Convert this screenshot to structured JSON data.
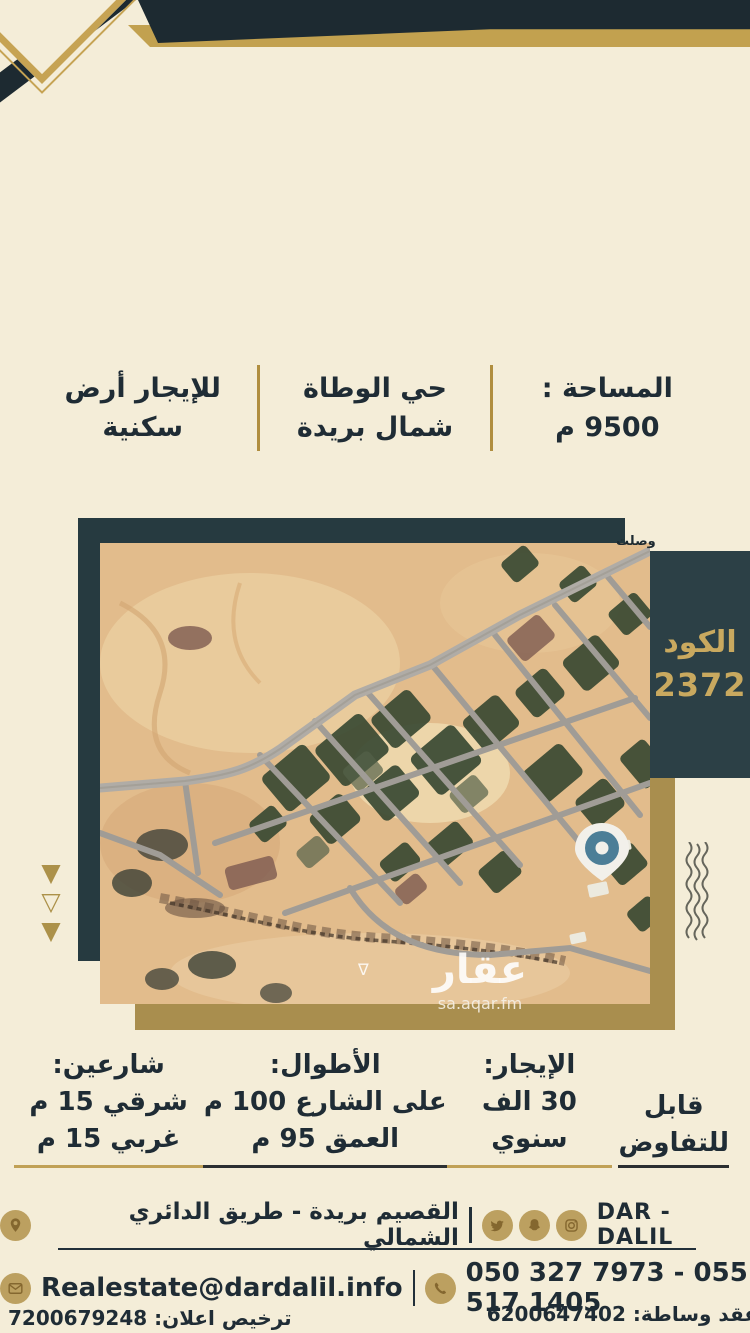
{
  "top_info": {
    "listing": {
      "line1": "للإيجار أرض",
      "line2": "سكنية"
    },
    "location": {
      "line1": "حي الوطاة",
      "line2": "شمال بريدة"
    },
    "area": {
      "line1": "المساحة :",
      "line2": "9500 م"
    }
  },
  "map": {
    "code_label": "الكود",
    "code_value": "2372",
    "corner_text": "وصلت",
    "watermark_wasalt": "wasalt.com",
    "watermark_aqar": "عقار",
    "watermark_aqar_domain": "sa.aqar.fm",
    "triangle_glyphs": {
      "filled": "▼",
      "hollow": "▽"
    }
  },
  "specs": {
    "streets": {
      "title": "شارعين:",
      "line1": "شرقي 15 م",
      "line2": "غربي 15 م"
    },
    "lengths": {
      "title": "الأطوال:",
      "line1": "على الشارع 100 م",
      "line2": "العمق 95 م"
    },
    "rent": {
      "title": "الإيجار:",
      "line1": "30 الف سنوي"
    },
    "negotiable": {
      "line1": "قابل",
      "line2": "للتفاوض"
    }
  },
  "footer": {
    "brand": "DAR - DALIL",
    "address": "القصيم بريدة - طريق الدائري الشمالي",
    "email": "Realestate@dardalil.info",
    "phones": "050 327 7973 - 055 517 1405",
    "license": "ترخيص اعلان: 7200679248",
    "brokerage": "عقد وساطة: 6200647402",
    "icons": [
      "instagram-icon",
      "snapchat-icon",
      "twitter-icon",
      "location-pin-icon",
      "envelope-icon",
      "phone-icon"
    ]
  },
  "colors": {
    "background": "#f4edd8",
    "dark_navy": "#1d2a31",
    "frame_teal": "#263a40",
    "panel_teal": "#2c4046",
    "gold": "#c2a14f",
    "gold_dark": "#a98e4e",
    "code_text_gold": "#c9a95f",
    "pin_blue": "#4c7e97"
  }
}
